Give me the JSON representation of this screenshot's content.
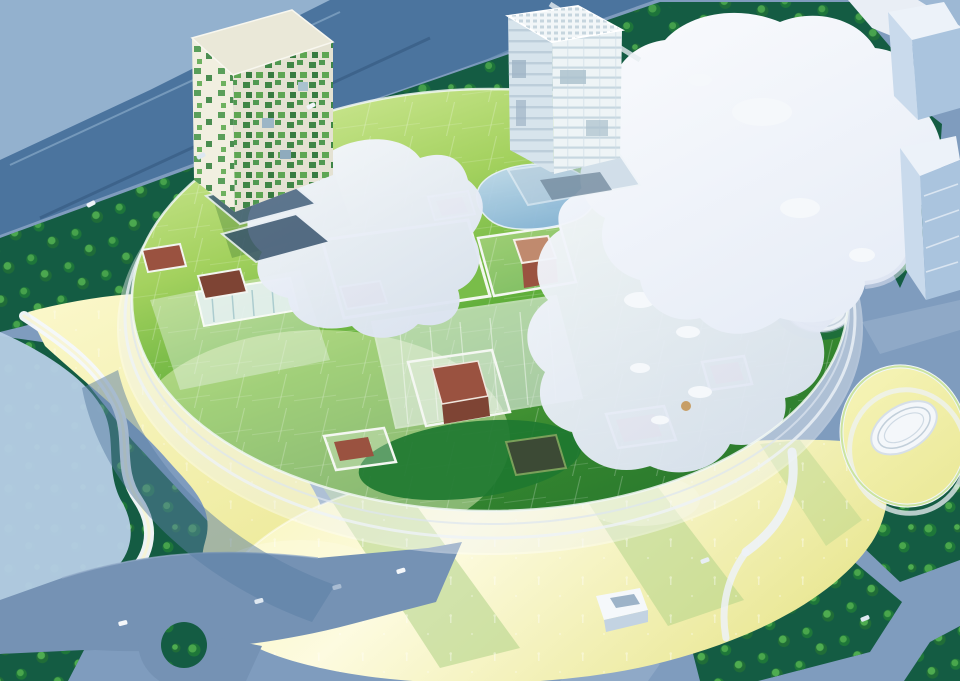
{
  "labels": {
    "scene": "aerial photo of architectural model with circular green-roof building",
    "highway": "elevated highway top-left",
    "trees": "dark green tree areas",
    "canopy": "white amoeba canopy field",
    "disc": "circular building with translucent green roof",
    "pond": "rooftop pond",
    "cloud_left": "white cloud roof plate west",
    "cloud_right": "white cloud roof plate east with round pads",
    "checker_tower": "tower with green pixel facade",
    "glass_tower": "white glass tower",
    "plaza_left": "yellow plaza west with curved white pavilion",
    "plaza_bottom": "yellow plaza south",
    "roads": "access roads with roundabout",
    "roundabout": "roundabout with green island",
    "donut": "oval courtyard building east",
    "neighbors": "neighboring light blue buildings",
    "walkways": "white pedestrian walkways",
    "courtyards": "roof courtyards with brick volumes",
    "service_box": "white service building on south plaza",
    "hole": "round roof opening with cylindrical pavilion"
  },
  "palette": {
    "ground": "#7f9cbe",
    "highway": "#4b749e",
    "highway_roof": "#93b1ce",
    "road": "#7592b4",
    "road_light": "#6b8fb2",
    "sidewalk": "#94adc9",
    "dark_green": "#145c43",
    "tree_green": "#2f9447",
    "pale_band": "#b6cde6",
    "shadow_blue": "#5a7da3",
    "roof_light": "#d6ec9e",
    "roof_mid": "#5fae3a",
    "roof_dark": "#2a7a2e",
    "lawn": "#79bd49",
    "plaza_yellow": "#f4f1a8",
    "plaza_bright": "#fdfbe0",
    "shadow_band": "#aed186",
    "cloud": "#eef1f9",
    "cloud_shade": "#d8e0f0",
    "canopy": "#f7f9fc",
    "pond": "#9ec7e8",
    "brick": "#9a5240",
    "brick_light": "#c08a6e",
    "brick_dark": "#7e4434",
    "sunken": "#3c4a35",
    "tower_top": "#eae8d8",
    "tower_left": "#f1efe0",
    "tower_right": "#e4e2d2",
    "checker_green": "#2d7c36",
    "glass_left": "#d7e4ec",
    "glass_right": "#eef4f6",
    "glass_top": "#f2f6f8",
    "neighbor_top": "#ecf2f9",
    "neighbor_front": "#c9daec",
    "neighbor_side": "#aac4de",
    "donut_ring": "#f2f0ac",
    "white": "#f5f8fb",
    "table_white": "#e9eef5",
    "corner_blue": "#9db8d4",
    "dark_oval": "#1e7830",
    "hole_green": "#1e6e3a"
  }
}
